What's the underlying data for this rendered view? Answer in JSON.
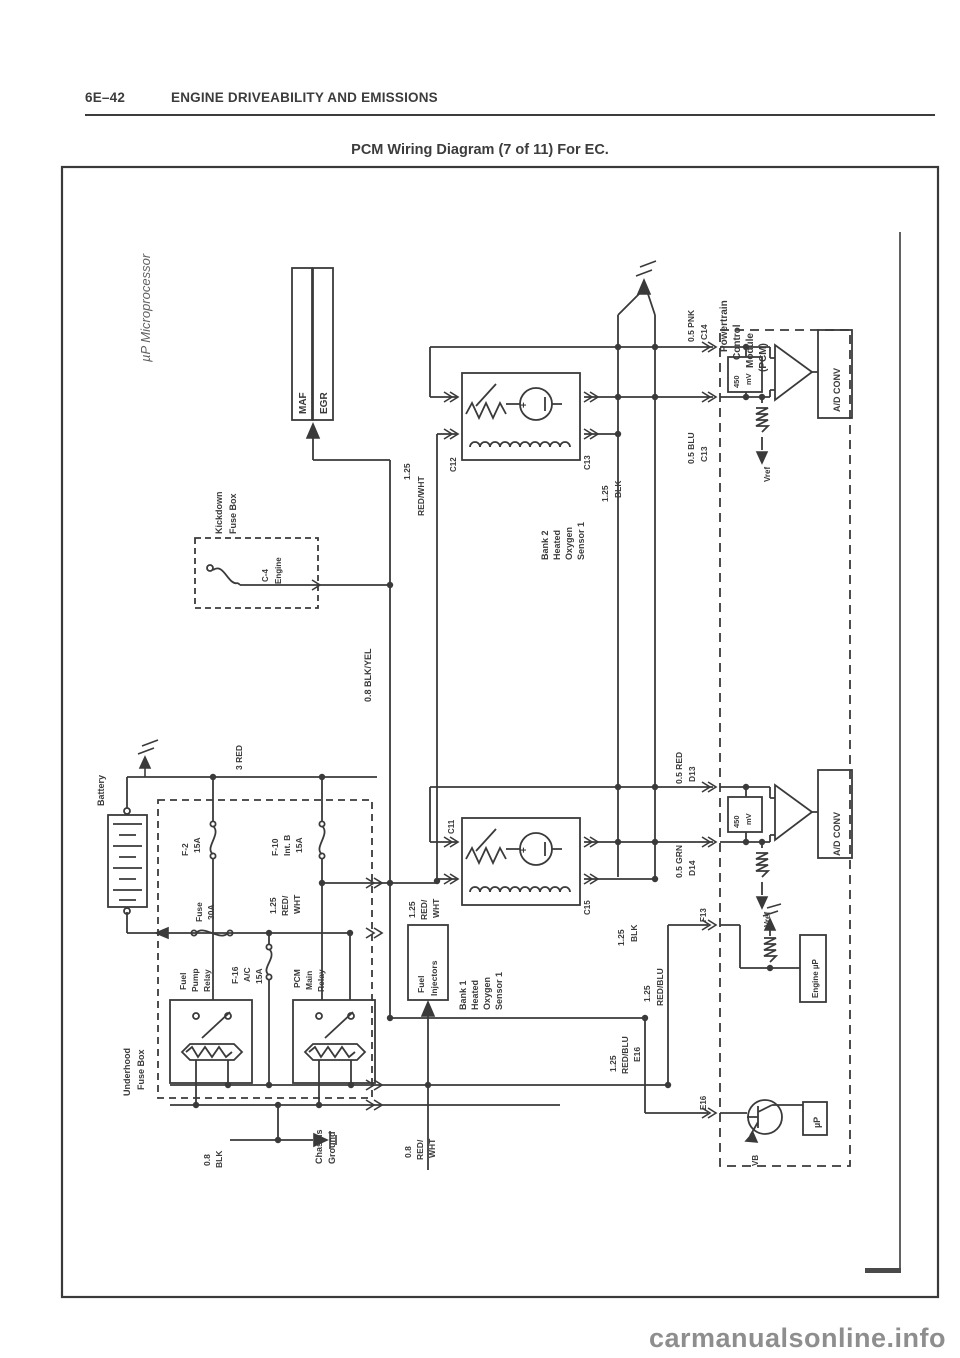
{
  "header": {
    "page_code": "6E–42",
    "section": "ENGINE DRIVEABILITY AND EMISSIONS",
    "title": "PCM Wiring Diagram (7 of 11) For EC."
  },
  "watermark": "carmanualsonline.info",
  "colors": {
    "ink": "#3a3a3a",
    "watermark": "#8e8e8e"
  },
  "d": {
    "note": "µP Microprocessor",
    "maf": "MAF",
    "egr": "EGR",
    "blkyel": "0.8 BLK/YEL",
    "kickdown": [
      "Kickdown",
      "Fuse Box"
    ],
    "c4": [
      "C-4",
      "Engine"
    ],
    "s2": {
      "name": [
        "Bank 2",
        "Heated",
        "Oxygen",
        "Sensor 1"
      ],
      "redwht": [
        "1.25",
        "RED/WHT"
      ],
      "blk": [
        "1.25",
        "BLK"
      ],
      "pin_l": "C12",
      "pin_r": "C13"
    },
    "s1": {
      "name": [
        "Bank 1",
        "Heated",
        "Oxygen",
        "Sensor 1"
      ],
      "redwht": [
        "1.25",
        "RED/",
        "WHT"
      ],
      "blk": [
        "1.25",
        "BLK"
      ],
      "pin_l": "C11",
      "pin_r": "C15"
    },
    "pcm": {
      "name": [
        "Powertrain",
        "Control",
        "Module",
        "(PCM)"
      ],
      "pnk": [
        "0.5 PNK",
        "C14"
      ],
      "blu": [
        "0.5 BLU",
        "C13"
      ],
      "red": [
        "0.5 RED",
        "D13"
      ],
      "grn": [
        "0.5 GRN",
        "D14"
      ],
      "mv": [
        "450",
        "mV"
      ],
      "adconv": "A/D CONV",
      "vref": "Vref",
      "f13": "F13",
      "e16": "E16",
      "engine_up": "Engine µP",
      "up": "µP",
      "vb": "VB",
      "redblu_f": [
        "1.25",
        "RED/BLU"
      ],
      "redblu_e": [
        "1.25",
        "RED/BLU",
        "E16"
      ]
    },
    "batt": {
      "label": "Battery",
      "red3": "3 RED"
    },
    "fuses": {
      "f2": [
        "F-2",
        "15A"
      ],
      "f10": [
        "F-10",
        "Int. B",
        "15A"
      ],
      "f30": [
        "Fuse",
        "30A"
      ],
      "f16": [
        "F-16",
        "A/C",
        "15A"
      ]
    },
    "feed": [
      "1.25",
      "RED/",
      "WHT"
    ],
    "relays": {
      "fp": [
        "Fuel",
        "Pump",
        "Relay"
      ],
      "main": [
        "PCM",
        "Main",
        "Relay"
      ]
    },
    "underhood": [
      "Underhood",
      "Fuse Box"
    ],
    "inj": {
      "box": [
        "Fuel",
        "Injectors"
      ],
      "wire": [
        "0.8",
        "RED/",
        "WHT"
      ]
    },
    "gnd": {
      "chassis": [
        "Chassis",
        "Ground"
      ],
      "blk": [
        "0.8",
        "BLK"
      ]
    }
  }
}
